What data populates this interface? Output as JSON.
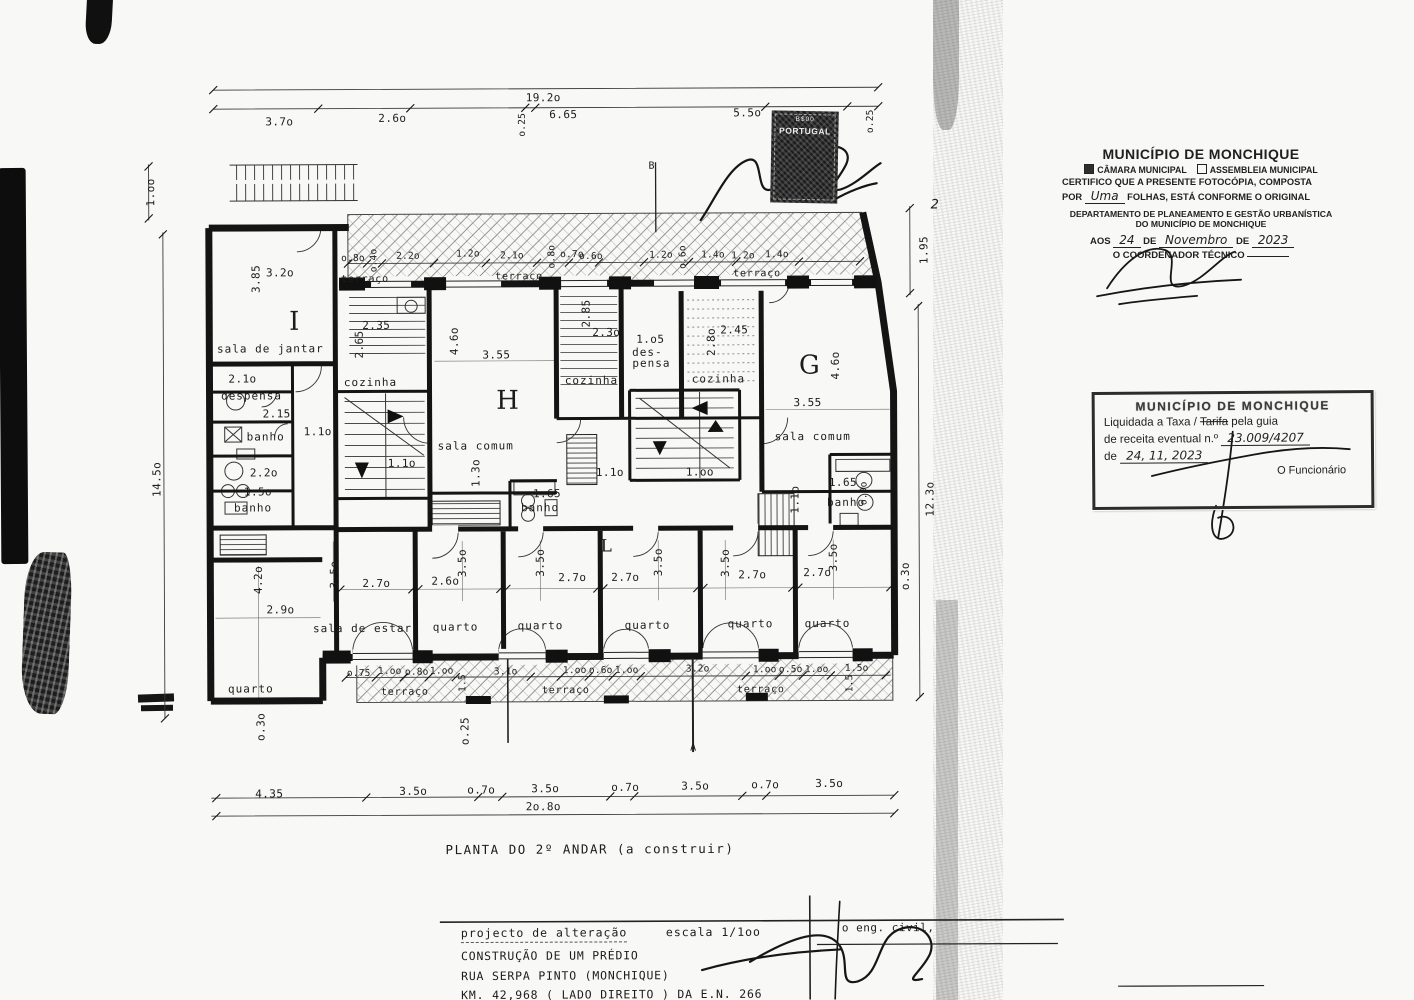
{
  "meta": {
    "colors": {
      "paper": "#f8f8f6",
      "ink": "#1a1a1a",
      "stamp_dark": "#1b1b1b"
    }
  },
  "document": {
    "plan_title": "PLANTA DO 2º ANDAR (a construir)",
    "title_block": {
      "project_type": "projecto de alteração",
      "scale_label": "escala  1/1oo",
      "engineer_label": "o eng. civil,",
      "line1": "CONSTRUÇÃO DE UM PRÉDIO",
      "line2": "RUA SERPA PINTO (MONCHIQUE)",
      "line3": "KM. 42,968 ( LADO DIREITO ) DA E.N. 266"
    }
  },
  "stamps": {
    "fiscal": {
      "value": "B$00",
      "country": "PORTUGAL"
    },
    "certification": {
      "title": "MUNICÍPIO DE MONCHIQUE",
      "option1": "CÂMARA MUNICIPAL",
      "option1_checked": true,
      "option2": "ASSEMBLEIA MUNICIPAL",
      "option2_checked": false,
      "body1": "CERTIFICO QUE A PRESENTE FOTOCÓPIA, COMPOSTA",
      "body2_prefix": "POR",
      "body2_hand": "Uma",
      "body2_suffix": "FOLHAS, ESTÁ CONFORME O ORIGINAL",
      "dept1": "DEPARTAMENTO DE PLANEAMENTO E GESTÃO URBANÍSTICA",
      "dept2": "DO MUNICÍPIO DE MONCHIQUE",
      "date_prefix": "AOS",
      "date_day": "24",
      "date_de1": "DE",
      "date_month": "Novembro",
      "date_de2": "DE",
      "date_year": "2023",
      "coordinator": "O COORDENADOR TÉCNICO"
    },
    "tax": {
      "title": "MUNICÍPIO DE MONCHIQUE",
      "line1_a": "Liquidada a Taxa /",
      "line1_strike": "Tarifa",
      "line1_b": "pela guia",
      "line2_prefix": "de receita eventual n.º",
      "line2_hand": "23.009/4207",
      "line3_prefix": "de",
      "line3_hand": "24, 11, 2023",
      "signoff": "O Funcionário"
    }
  },
  "plan": {
    "section_markers": [
      "A",
      "B"
    ],
    "labels": [
      {
        "t": "19.2o",
        "x": 545,
        "y": 97,
        "c": "d"
      },
      {
        "t": "3.7o",
        "x": 281,
        "y": 120,
        "c": "d"
      },
      {
        "t": "2.6o",
        "x": 394,
        "y": 117,
        "c": "d"
      },
      {
        "t": "o.25",
        "x": 524,
        "y": 124,
        "r": -90,
        "c": "ds"
      },
      {
        "t": "6.65",
        "x": 565,
        "y": 114,
        "c": "d"
      },
      {
        "t": "5.5o",
        "x": 749,
        "y": 113,
        "c": "d"
      },
      {
        "t": "o.25",
        "x": 872,
        "y": 122,
        "r": -90,
        "c": "ds"
      },
      {
        "t": "1.oo",
        "x": 152,
        "y": 190,
        "r": -90,
        "c": "d"
      },
      {
        "t": "14.5o",
        "x": 157,
        "y": 477,
        "r": -90,
        "c": "d"
      },
      {
        "t": "1.95",
        "x": 925,
        "y": 251,
        "r": -90,
        "c": "d"
      },
      {
        "t": "12.3o",
        "x": 930,
        "y": 500,
        "r": -90,
        "c": "d"
      },
      {
        "t": "2",
        "x": 936,
        "y": 206,
        "c": "hd"
      },
      {
        "t": "o.8o",
        "x": 354,
        "y": 257,
        "c": "ds"
      },
      {
        "t": "o.4o",
        "x": 375,
        "y": 259,
        "r": -90,
        "c": "ds"
      },
      {
        "t": "2.2o",
        "x": 409,
        "y": 255,
        "c": "ds"
      },
      {
        "t": "1.2o",
        "x": 469,
        "y": 253,
        "c": "ds"
      },
      {
        "t": "2.1o",
        "x": 513,
        "y": 255,
        "c": "ds"
      },
      {
        "t": "o.8o",
        "x": 553,
        "y": 256,
        "r": -90,
        "c": "ds"
      },
      {
        "t": "o.7o",
        "x": 573,
        "y": 254,
        "c": "ds"
      },
      {
        "t": "o.6o",
        "x": 592,
        "y": 256,
        "c": "ds"
      },
      {
        "t": "1.2o",
        "x": 662,
        "y": 255,
        "c": "ds"
      },
      {
        "t": "o.6o",
        "x": 684,
        "y": 257,
        "r": -90,
        "c": "ds"
      },
      {
        "t": "1.4o",
        "x": 714,
        "y": 255,
        "c": "ds"
      },
      {
        "t": "1.2o",
        "x": 744,
        "y": 256,
        "c": "ds"
      },
      {
        "t": "1.4o",
        "x": 778,
        "y": 255,
        "c": "ds"
      },
      {
        "t": "terraço",
        "x": 366,
        "y": 278,
        "c": "rs"
      },
      {
        "t": "terraço",
        "x": 520,
        "y": 276,
        "c": "rs"
      },
      {
        "t": "terraço",
        "x": 758,
        "y": 274,
        "c": "rs"
      },
      {
        "t": "3.2o",
        "x": 281,
        "y": 271,
        "c": "d"
      },
      {
        "t": "3.85",
        "x": 257,
        "y": 277,
        "r": -90,
        "c": "d"
      },
      {
        "t": "I",
        "x": 295,
        "y": 320,
        "c": "ap"
      },
      {
        "t": "sala de jantar",
        "x": 271,
        "y": 347,
        "c": "rm"
      },
      {
        "t": "2.1o",
        "x": 243,
        "y": 377,
        "c": "d"
      },
      {
        "t": "despensa",
        "x": 252,
        "y": 394,
        "c": "rm"
      },
      {
        "t": "2.15",
        "x": 277,
        "y": 412,
        "c": "d"
      },
      {
        "t": "banho",
        "x": 266,
        "y": 435,
        "c": "rm"
      },
      {
        "t": "1.1o",
        "x": 318,
        "y": 430,
        "c": "d"
      },
      {
        "t": "2.2o",
        "x": 264,
        "y": 471,
        "c": "d"
      },
      {
        "t": "1.5o",
        "x": 258,
        "y": 490,
        "c": "d"
      },
      {
        "t": "banho",
        "x": 253,
        "y": 506,
        "c": "rm"
      },
      {
        "t": "2.35",
        "x": 377,
        "y": 324,
        "c": "d"
      },
      {
        "t": "2.65",
        "x": 360,
        "y": 343,
        "r": -90,
        "c": "d"
      },
      {
        "t": "cozinha",
        "x": 371,
        "y": 381,
        "c": "rm"
      },
      {
        "t": "1.1o",
        "x": 402,
        "y": 462,
        "c": "d"
      },
      {
        "t": "4.6o",
        "x": 455,
        "y": 340,
        "r": -90,
        "c": "d"
      },
      {
        "t": "3.55",
        "x": 497,
        "y": 354,
        "c": "d"
      },
      {
        "t": "H",
        "x": 508,
        "y": 400,
        "c": "ap"
      },
      {
        "t": "sala comum",
        "x": 476,
        "y": 445,
        "c": "rm"
      },
      {
        "t": "1.3o",
        "x": 476,
        "y": 472,
        "r": -90,
        "c": "d"
      },
      {
        "t": "2.85",
        "x": 587,
        "y": 313,
        "r": -90,
        "c": "d"
      },
      {
        "t": "2.3o",
        "x": 607,
        "y": 332,
        "c": "d"
      },
      {
        "t": "cozinha",
        "x": 592,
        "y": 380,
        "c": "rm"
      },
      {
        "t": "1.o5",
        "x": 651,
        "y": 339,
        "c": "d"
      },
      {
        "t": "des-",
        "x": 648,
        "y": 352,
        "c": "rm"
      },
      {
        "t": "pensa",
        "x": 652,
        "y": 363,
        "c": "rm"
      },
      {
        "t": "2.8o",
        "x": 712,
        "y": 342,
        "r": -90,
        "c": "d"
      },
      {
        "t": "2.45",
        "x": 735,
        "y": 330,
        "c": "d"
      },
      {
        "t": "cozinha",
        "x": 719,
        "y": 379,
        "c": "rm"
      },
      {
        "t": "G",
        "x": 810,
        "y": 366,
        "c": "ap"
      },
      {
        "t": "4.6o",
        "x": 836,
        "y": 366,
        "r": -90,
        "c": "d"
      },
      {
        "t": "3.55",
        "x": 808,
        "y": 403,
        "c": "d"
      },
      {
        "t": "sala comum",
        "x": 813,
        "y": 437,
        "c": "rm"
      },
      {
        "t": "1.65",
        "x": 843,
        "y": 483,
        "c": "d"
      },
      {
        "t": "banho",
        "x": 846,
        "y": 503,
        "c": "rm"
      },
      {
        "t": "o.9o",
        "x": 864,
        "y": 494,
        "r": -90,
        "c": "ds"
      },
      {
        "t": "1.1o",
        "x": 795,
        "y": 500,
        "r": -90,
        "c": "d"
      },
      {
        "t": "1.1o",
        "x": 610,
        "y": 472,
        "c": "d"
      },
      {
        "t": "1.oo",
        "x": 700,
        "y": 472,
        "c": "d"
      },
      {
        "t": "1.65",
        "x": 547,
        "y": 493,
        "c": "d"
      },
      {
        "t": "banho",
        "x": 540,
        "y": 507,
        "c": "rm"
      },
      {
        "t": "L",
        "x": 606,
        "y": 546,
        "c": "ap2"
      },
      {
        "t": "4.2o",
        "x": 258,
        "y": 578,
        "r": -90,
        "c": "d"
      },
      {
        "t": "2.9o",
        "x": 280,
        "y": 608,
        "c": "d"
      },
      {
        "t": "quarto",
        "x": 250,
        "y": 687,
        "c": "rm"
      },
      {
        "t": "3.5o",
        "x": 334,
        "y": 573,
        "r": -90,
        "c": "d"
      },
      {
        "t": "2.7o",
        "x": 376,
        "y": 582,
        "c": "d"
      },
      {
        "t": "sala de estar",
        "x": 362,
        "y": 627,
        "c": "rm"
      },
      {
        "t": "2.6o",
        "x": 445,
        "y": 580,
        "c": "d"
      },
      {
        "t": "3.5o",
        "x": 462,
        "y": 562,
        "r": -90,
        "c": "d"
      },
      {
        "t": "quarto",
        "x": 455,
        "y": 626,
        "c": "rm"
      },
      {
        "t": "2.7o",
        "x": 572,
        "y": 577,
        "c": "d"
      },
      {
        "t": "3.5o",
        "x": 540,
        "y": 562,
        "r": -90,
        "c": "d"
      },
      {
        "t": "quarto",
        "x": 540,
        "y": 625,
        "c": "rm"
      },
      {
        "t": "2.7o",
        "x": 625,
        "y": 577,
        "c": "d"
      },
      {
        "t": "3.5o",
        "x": 658,
        "y": 562,
        "r": -90,
        "c": "d"
      },
      {
        "t": "quarto",
        "x": 647,
        "y": 625,
        "c": "rm"
      },
      {
        "t": "3.5o",
        "x": 725,
        "y": 563,
        "r": -90,
        "c": "d"
      },
      {
        "t": "2.7o",
        "x": 752,
        "y": 575,
        "c": "d"
      },
      {
        "t": "quarto",
        "x": 750,
        "y": 624,
        "c": "rm"
      },
      {
        "t": "2.7o",
        "x": 817,
        "y": 573,
        "c": "d"
      },
      {
        "t": "3.5o",
        "x": 833,
        "y": 558,
        "r": -90,
        "c": "d"
      },
      {
        "t": "quarto",
        "x": 827,
        "y": 624,
        "c": "rm"
      },
      {
        "t": "o.3o",
        "x": 905,
        "y": 577,
        "r": -90,
        "c": "d"
      },
      {
        "t": "o.3o",
        "x": 260,
        "y": 725,
        "r": -90,
        "c": "d"
      },
      {
        "t": "o.75",
        "x": 358,
        "y": 672,
        "c": "ds"
      },
      {
        "t": "1.oo",
        "x": 389,
        "y": 670,
        "c": "ds"
      },
      {
        "t": "o.8o",
        "x": 416,
        "y": 671,
        "c": "ds"
      },
      {
        "t": "1.oo",
        "x": 441,
        "y": 670,
        "c": "ds"
      },
      {
        "t": "terraço",
        "x": 404,
        "y": 691,
        "c": "rs"
      },
      {
        "t": "1.5",
        "x": 462,
        "y": 682,
        "r": -90,
        "c": "ds"
      },
      {
        "t": "o.25",
        "x": 464,
        "y": 730,
        "r": -90,
        "c": "d"
      },
      {
        "t": "3.1o",
        "x": 505,
        "y": 671,
        "c": "ds"
      },
      {
        "t": "1.oo",
        "x": 574,
        "y": 670,
        "c": "ds"
      },
      {
        "t": "o.6o",
        "x": 600,
        "y": 670,
        "c": "ds"
      },
      {
        "t": "1.oo",
        "x": 626,
        "y": 670,
        "c": "ds"
      },
      {
        "t": "terraço",
        "x": 565,
        "y": 690,
        "c": "rs"
      },
      {
        "t": "3.2o",
        "x": 697,
        "y": 669,
        "c": "ds"
      },
      {
        "t": "1.oo",
        "x": 764,
        "y": 670,
        "c": "ds"
      },
      {
        "t": "o.5o",
        "x": 790,
        "y": 670,
        "c": "ds"
      },
      {
        "t": "1.oo",
        "x": 816,
        "y": 670,
        "c": "ds"
      },
      {
        "t": "1.5o",
        "x": 856,
        "y": 669,
        "c": "ds"
      },
      {
        "t": "1.5",
        "x": 849,
        "y": 684,
        "r": -90,
        "c": "ds"
      },
      {
        "t": "terraço",
        "x": 760,
        "y": 690,
        "c": "rs"
      },
      {
        "t": "4.35",
        "x": 268,
        "y": 792,
        "c": "d"
      },
      {
        "t": "3.5o",
        "x": 412,
        "y": 790,
        "c": "d"
      },
      {
        "t": "o.7o",
        "x": 480,
        "y": 789,
        "c": "d"
      },
      {
        "t": "3.5o",
        "x": 544,
        "y": 788,
        "c": "d"
      },
      {
        "t": "o.7o",
        "x": 624,
        "y": 787,
        "c": "d"
      },
      {
        "t": "3.5o",
        "x": 694,
        "y": 786,
        "c": "d"
      },
      {
        "t": "o.7o",
        "x": 764,
        "y": 785,
        "c": "d"
      },
      {
        "t": "3.5o",
        "x": 828,
        "y": 784,
        "c": "d"
      },
      {
        "t": "2o.8o",
        "x": 542,
        "y": 806,
        "c": "d"
      },
      {
        "t": "B",
        "x": 653,
        "y": 166,
        "c": "mk"
      },
      {
        "t": "A",
        "x": 692,
        "y": 748,
        "c": "mk"
      }
    ]
  }
}
